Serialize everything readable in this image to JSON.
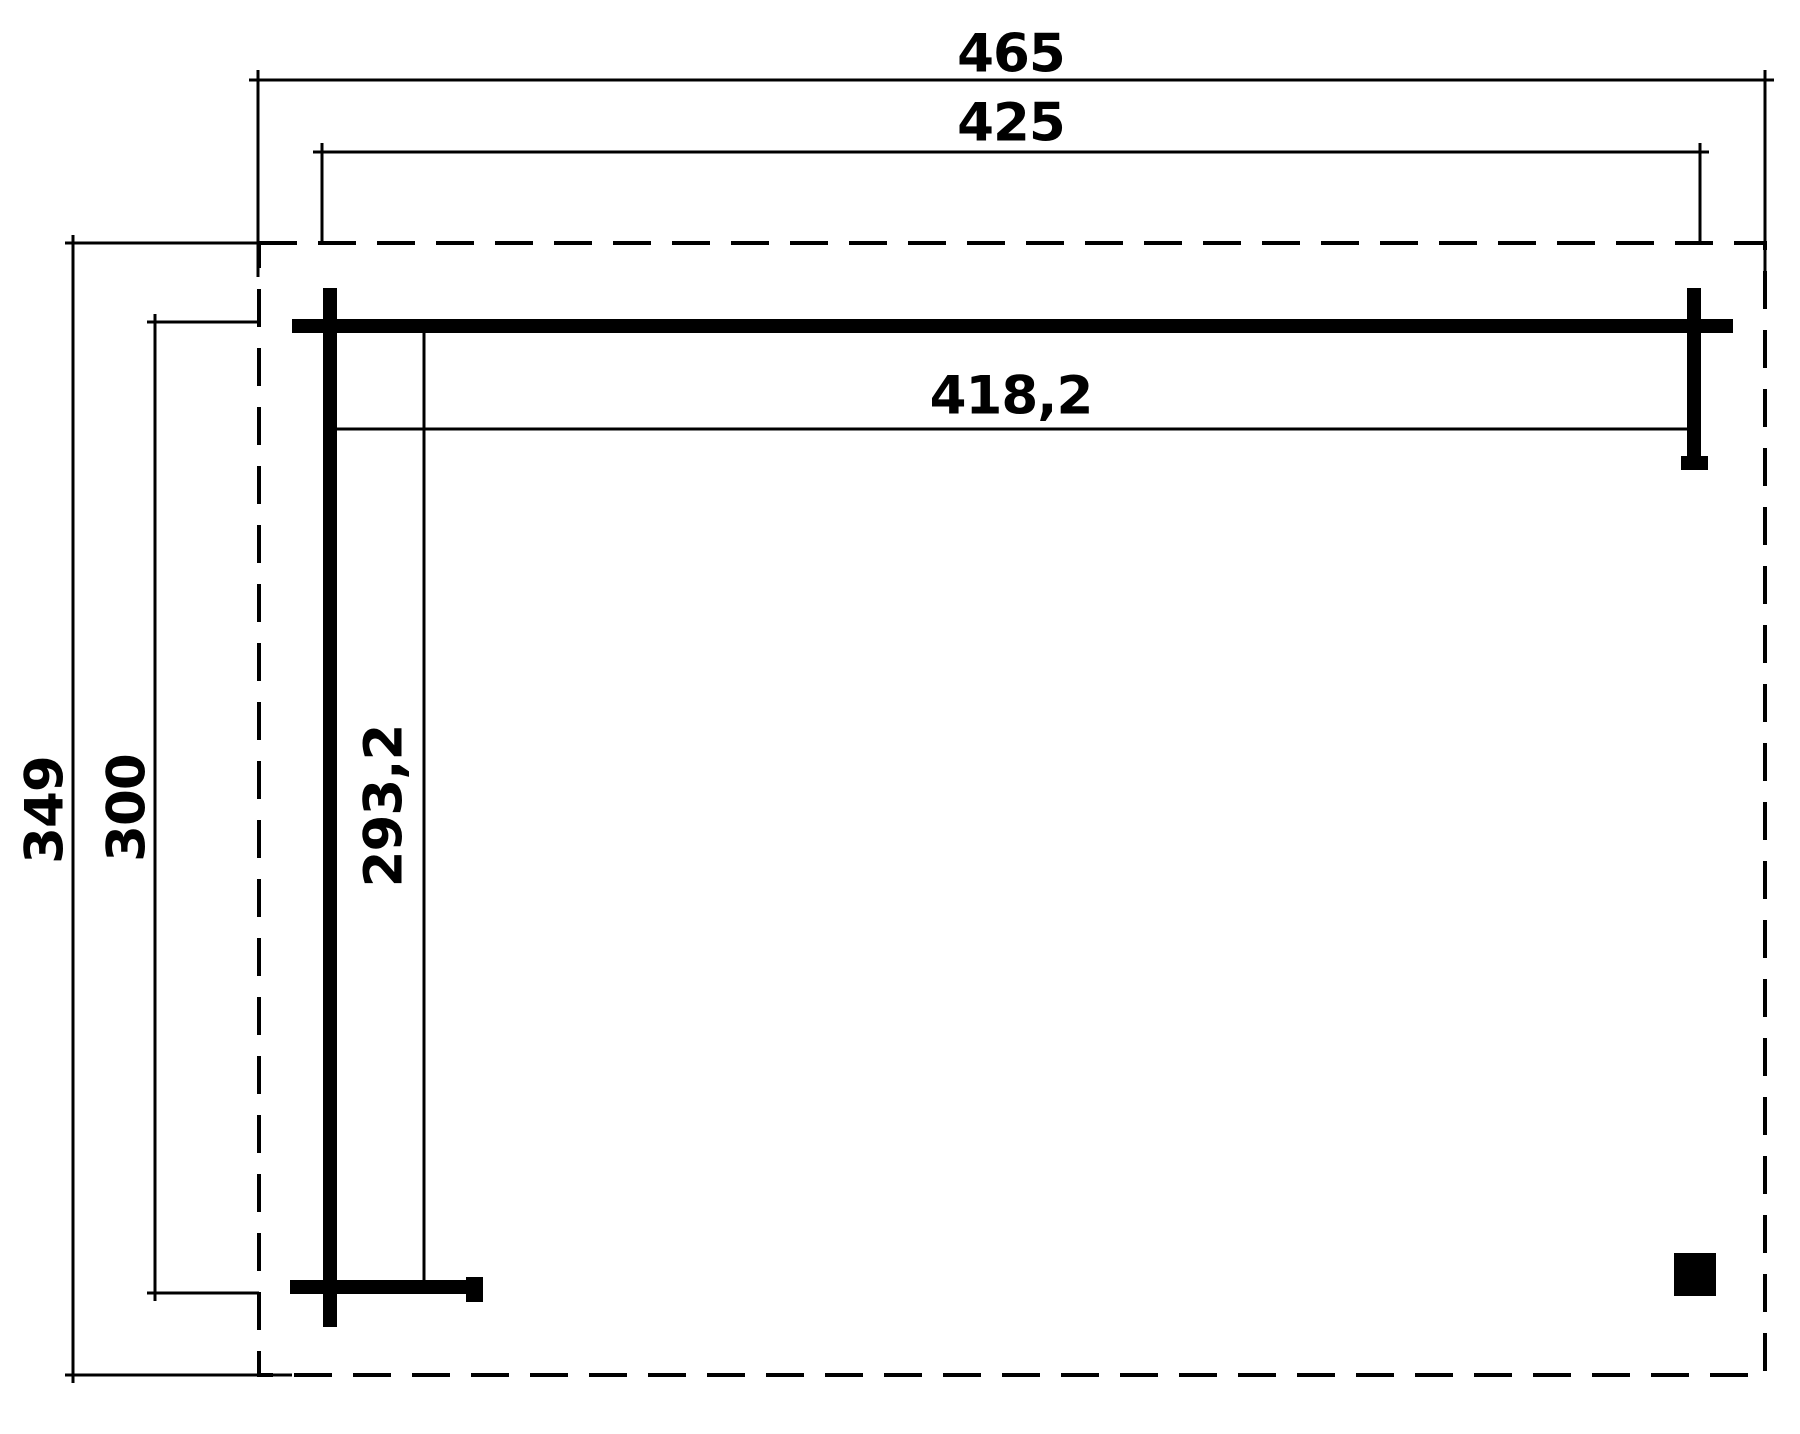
{
  "diagram": {
    "type": "floor-plan-dimension-drawing",
    "background_color": "#ffffff",
    "line_color": "#000000",
    "roof_outline_style": "dashed",
    "dimensions": {
      "roof_width": "465",
      "frame_width": "425",
      "inner_width": "418,2",
      "roof_depth": "349",
      "frame_depth": "300",
      "inner_depth": "293,2"
    }
  }
}
